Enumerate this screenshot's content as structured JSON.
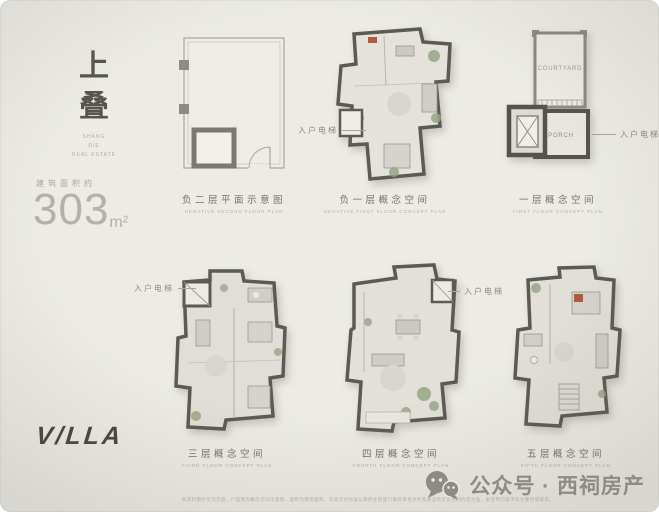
{
  "page": {
    "bg": "#ECEBE6",
    "accent_wall": "#5C5A54",
    "accent_green": "#96A485",
    "accent_red": "#B2593F"
  },
  "left_panel": {
    "title_char_1": "上",
    "title_char_2": "叠",
    "subtitle_line_1": "SHANG",
    "subtitle_line_2": "DIE",
    "subtitle_line_3": "REAL ESTATE",
    "area_label": "建筑面积约",
    "area_value": "303",
    "area_unit": "m²",
    "logo_text": "V/LLA"
  },
  "plans": [
    {
      "caption": "负二层平面示意图",
      "caption_en": "NEGATIVE SECOND FLOOR PLAN"
    },
    {
      "caption": "负一层概念空间",
      "caption_en": "NEGATIVE FIRST FLOOR CONCEPT PLAN",
      "elevator_label": "入户电梯"
    },
    {
      "caption": "一层概念空间",
      "caption_en": "FIRST FLOOR CONCEPT PLAN",
      "elevator_label": "入户电梯",
      "rooms": {
        "courtyard": "COURTYARD",
        "porch": "PORCH"
      }
    },
    {
      "caption": "三层概念空间",
      "caption_en": "THIRD FLOOR CONCEPT PLAN",
      "elevator_label": "入户电梯"
    },
    {
      "caption": "四层概念空间",
      "caption_en": "FOURTH FLOOR CONCEPT PLAN",
      "elevator_label": "入户电梯"
    },
    {
      "caption": "五层概念空间",
      "caption_en": "FIFTH FLOOR CONCEPT PLAN"
    }
  ],
  "footer": {
    "watermark_text": "公众号 · 西祠房产",
    "disclaimer": "本资料图片仅为示意，户型图为概念空间示意图，面积为建筑面积，实际交付标准以政府主管部门最终审批文件及商品房买卖合同约定为准，本宣传内容不作为要约或承诺。"
  }
}
